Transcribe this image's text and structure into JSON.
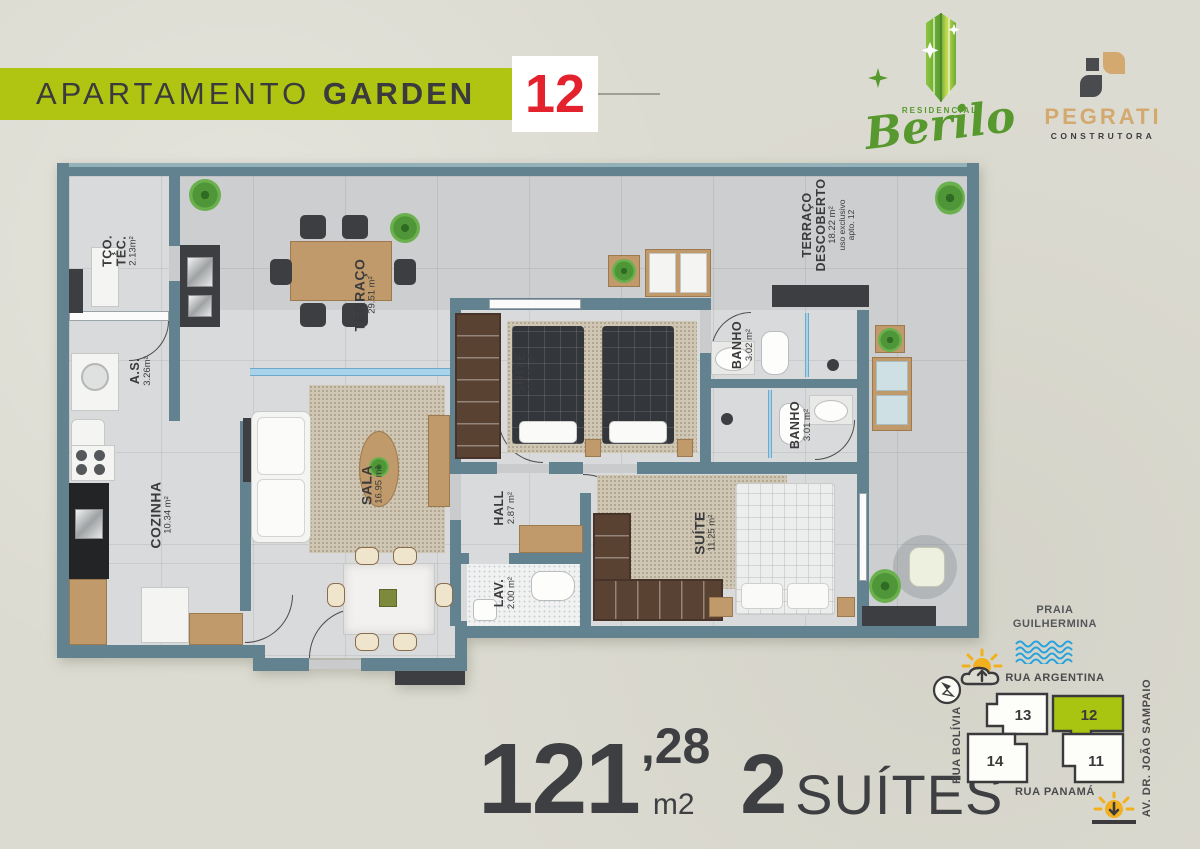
{
  "header": {
    "banner_regular": "APARTAMENTO ",
    "banner_bold": "GARDEN",
    "unit_number": "12"
  },
  "logos": {
    "berilo": {
      "top_label": "RESIDENCIAL",
      "name": "Berilo"
    },
    "pegrati": {
      "name": "PEGRATI",
      "subtitle": "CONSTRUTORA"
    }
  },
  "floorplan": {
    "rooms": {
      "tco_tec": {
        "name_lines": [
          "TÇO.",
          "TÉC."
        ],
        "area": "2.13m²"
      },
      "as": {
        "name": "A.S.",
        "area": "3.26m²"
      },
      "cozinha": {
        "name": "COZINHA",
        "area": "10.34 m²"
      },
      "sala": {
        "name": "SALA",
        "area": "16.95 m²"
      },
      "terraco": {
        "name": "TERRAÇO",
        "area": "29.51 m²"
      },
      "suite1": {
        "name": "SUÍTE",
        "area": "10.79 m²"
      },
      "banho1": {
        "name": "BANHO",
        "area": "3.02 m²"
      },
      "banho2": {
        "name": "BANHO",
        "area": "3.01 m²"
      },
      "hall": {
        "name": "HALL",
        "area": "2.87 m²"
      },
      "lav": {
        "name": "LAV.",
        "area": "2.00 m²"
      },
      "suite2": {
        "name": "SUÍTE",
        "area": "11.25 m²"
      },
      "terraco_descoberto": {
        "name_lines": [
          "TERRAÇO",
          "DESCOBERTO"
        ],
        "area": "18.22 m²",
        "notes": [
          "uso exclusivo",
          "apto. 12"
        ]
      }
    }
  },
  "summary": {
    "area_whole": "121",
    "area_fraction": ",28",
    "area_unit": "m2",
    "suites_number": "2",
    "suites_label": "SUÍTES"
  },
  "map": {
    "beach_line1": "PRAIA",
    "beach_line2": "GUILHERMINA",
    "street_top": "RUA ARGENTINA",
    "street_left": "RUA BOLÍVIA",
    "street_right": "AV. DR. JOÃO SAMPAIO",
    "street_bottom": "RUA PANAMÁ",
    "lots": [
      {
        "number": "13",
        "highlighted": false
      },
      {
        "number": "12",
        "highlighted": true
      },
      {
        "number": "14",
        "highlighted": false
      },
      {
        "number": "11",
        "highlighted": false
      }
    ]
  },
  "colors": {
    "banner_green": "#b0c512",
    "unit_red": "#e4222e",
    "wall_slate": "#62828f",
    "lot_green": "#a9c411",
    "water_blue": "#29a3dc",
    "sun_yellow": "#f2b01e",
    "text_dark": "#3b3b3d",
    "pegrati_tan": "#d3a96f",
    "berilo_green": "#57992f"
  }
}
